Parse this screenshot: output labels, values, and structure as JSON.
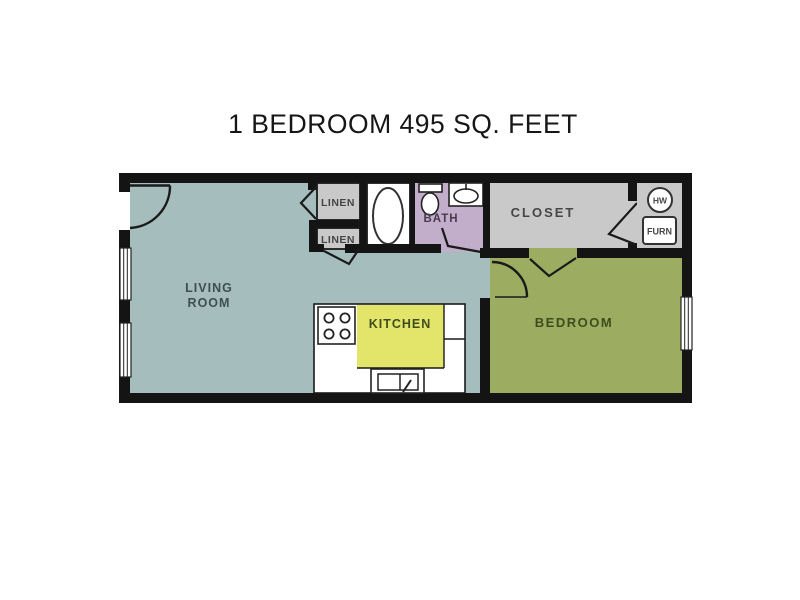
{
  "title": "1 BEDROOM 495 SQ. FEET",
  "floorplan": {
    "living_room": {
      "line1": "LIVING",
      "line2": "ROOM"
    },
    "kitchen": {
      "label": "KITCHEN"
    },
    "bedroom": {
      "label": "BEDROOM"
    },
    "bath": {
      "label": "BATH"
    },
    "closet": {
      "label": "CLOSET"
    },
    "linen_top": {
      "label": "LINEN"
    },
    "linen_bottom": {
      "label": "LINEN"
    },
    "utility": {
      "hot_water_label": "HW",
      "furnace_label": "FURN"
    }
  },
  "colors": {
    "wall": "#141414",
    "living_room": "#a5bdbc",
    "bedroom": "#9cad62",
    "kitchen": "#e3e46a",
    "bath": "#c2aecb",
    "closet_gray": "#c9c9c9",
    "fixture_white": "#ffffff",
    "title_text": "#161616",
    "label_teal": "#3d5050",
    "label_olive": "#3f4d1d",
    "label_gray": "#464646",
    "label_purple": "#473c4e"
  }
}
